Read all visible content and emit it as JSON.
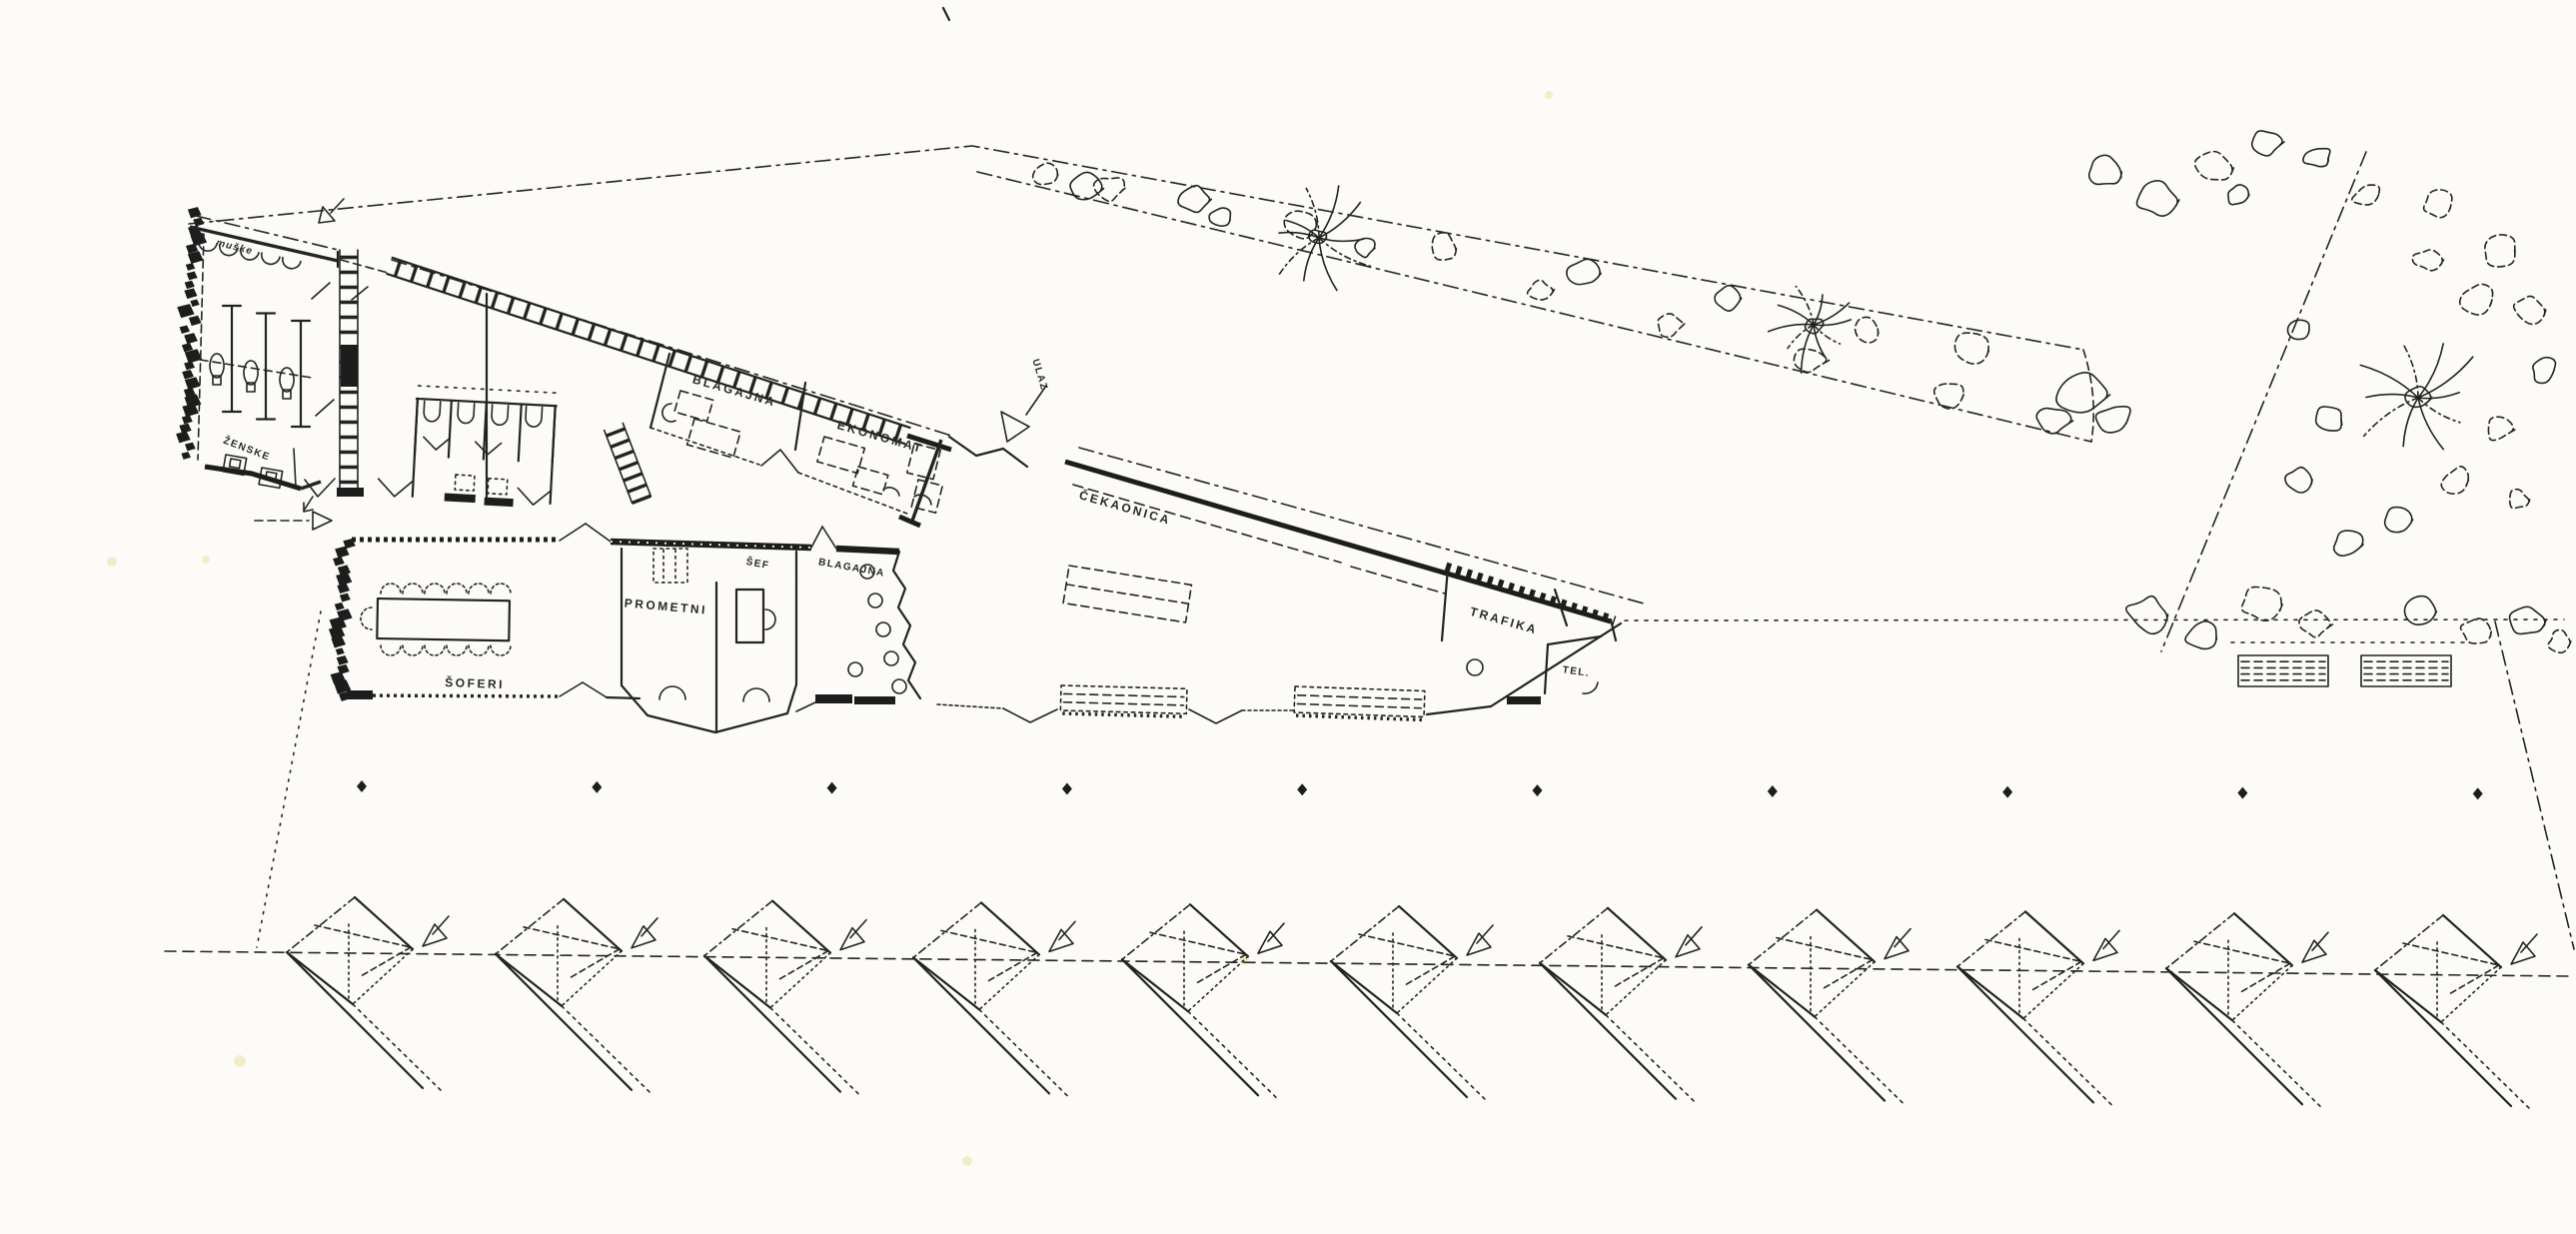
{
  "labels": {
    "muske": "MUŠKE",
    "zenske": "ŽENSKE",
    "blagajna_upper": "BLAGAJNA",
    "ekonomat": "EKONOMAT",
    "ulaz": "ULAZ",
    "cekaonica": "ČEKAONICA",
    "trafika": "TRAFIKA",
    "tel": "TEL.",
    "soferi": "ŠOFERI",
    "prometni": "PROMETNI",
    "sef": "ŠEF",
    "blagajna_lower": "BLAGAJNA"
  },
  "site": {
    "parking_stalls": 11,
    "platform_columns": 10,
    "waiting_hall_benches": 3,
    "platform_benches_east": 2,
    "palm_trees": 3,
    "colors": {
      "paper": "#fcfbf7",
      "ink": "#232323"
    }
  }
}
